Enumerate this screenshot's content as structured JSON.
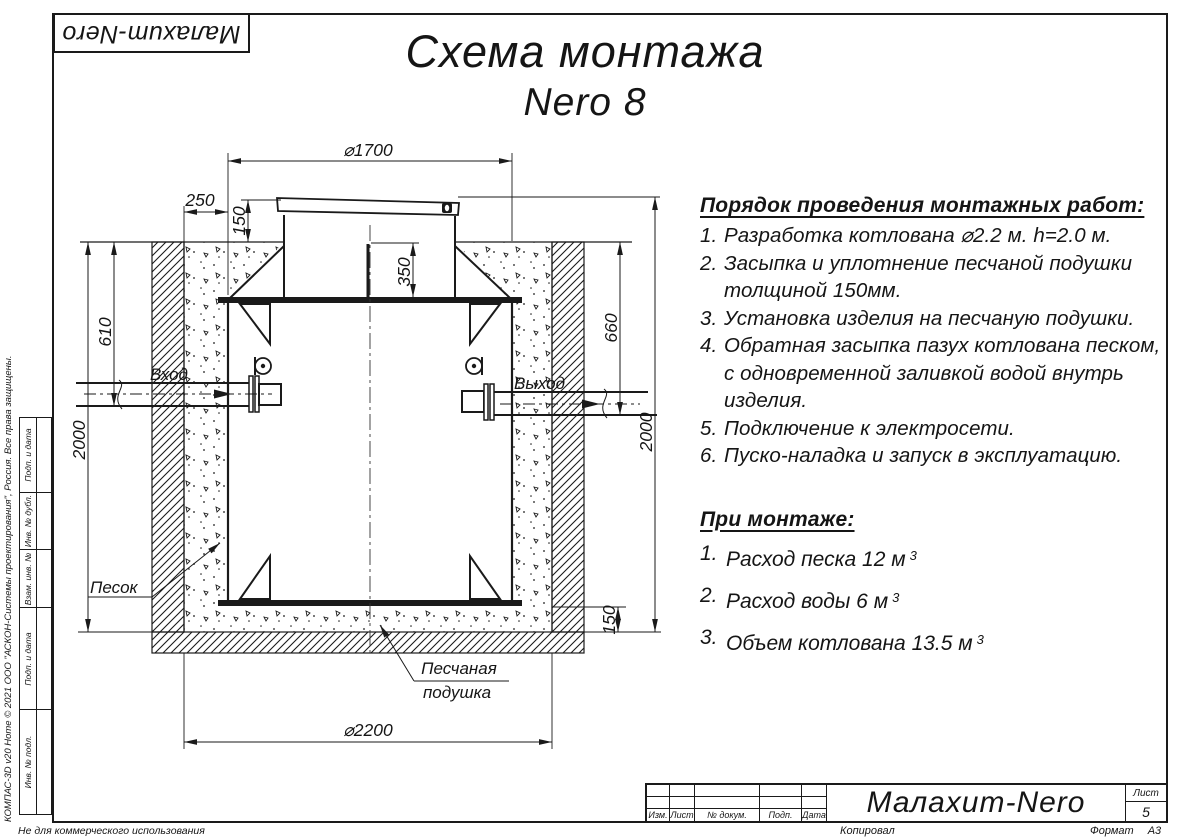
{
  "colors": {
    "ink": "#1a1a1a",
    "paper": "#ffffff"
  },
  "logo": {
    "text": "Малахит-Nero"
  },
  "title": {
    "line1": "Схема монтажа",
    "line2": "Nero 8"
  },
  "steps": {
    "heading": "Порядок проведения монтажных работ:",
    "items": [
      {
        "num": "1.",
        "lines": [
          "Разработка котлована ⌀2.2 м. h=2.0 м."
        ]
      },
      {
        "num": "2.",
        "lines": [
          "Засыпка и уплотнение песчаной подушки",
          "толщиной 150мм."
        ]
      },
      {
        "num": "3.",
        "lines": [
          "Установка изделия на песчаную подушки."
        ]
      },
      {
        "num": "4.",
        "lines": [
          "Обратная засыпка пазух котлована песком,",
          "с одновременной заливкой водой внутрь",
          "изделия."
        ]
      },
      {
        "num": "5.",
        "lines": [
          "Подключение к электросети."
        ]
      },
      {
        "num": "6.",
        "lines": [
          "Пуско-наладка и запуск в эксплуатацию."
        ]
      }
    ]
  },
  "mount": {
    "heading": "При монтаже:",
    "items": [
      {
        "num": "1.",
        "text": "Расход песка 12 м",
        "sup": "3"
      },
      {
        "num": "2.",
        "text": "Расход воды 6 м",
        "sup": "3"
      },
      {
        "num": "3.",
        "text": "Объем котлована 13.5 м",
        "sup": "3"
      }
    ]
  },
  "drawing": {
    "dim_top_diameter": "⌀1700",
    "dim_backfill_gap": "250",
    "dim_neck_height": "150",
    "dim_neck_depth": "350",
    "dim_inlet_depth": "610",
    "dim_pit_depth_left": "2000",
    "dim_outlet_depth": "660",
    "dim_pit_depth_right": "2000",
    "dim_cushion_thickness": "150",
    "dim_pit_diameter": "⌀2200",
    "label_inlet": "Вход",
    "label_outlet": "Выход",
    "label_sand": "Песок",
    "label_cushion_line1": "Песчаная",
    "label_cushion_line2": "подушка"
  },
  "title_block": {
    "cols": [
      "Изм.",
      "Лист",
      "№ докум.",
      "Подп.",
      "Дата"
    ],
    "product": "Малахит-Nero",
    "sheet_label": "Лист",
    "sheet_number": "5"
  },
  "stamp": {
    "cells": [
      "Подп. и дата",
      "Инв. № дубл.",
      "Взам. инв. №",
      "Подп. и дата",
      "Инв. № подл."
    ],
    "software": "КОМПАС-3D v20 Home © 2021 ООО \"АСКОН-Системы проектирования\", Россия. Все права защищены.",
    "not_commercial": "Не для коммерческого использования"
  },
  "footer": {
    "copied": "Копировал",
    "format_label": "Формат",
    "format_value": "А3"
  }
}
